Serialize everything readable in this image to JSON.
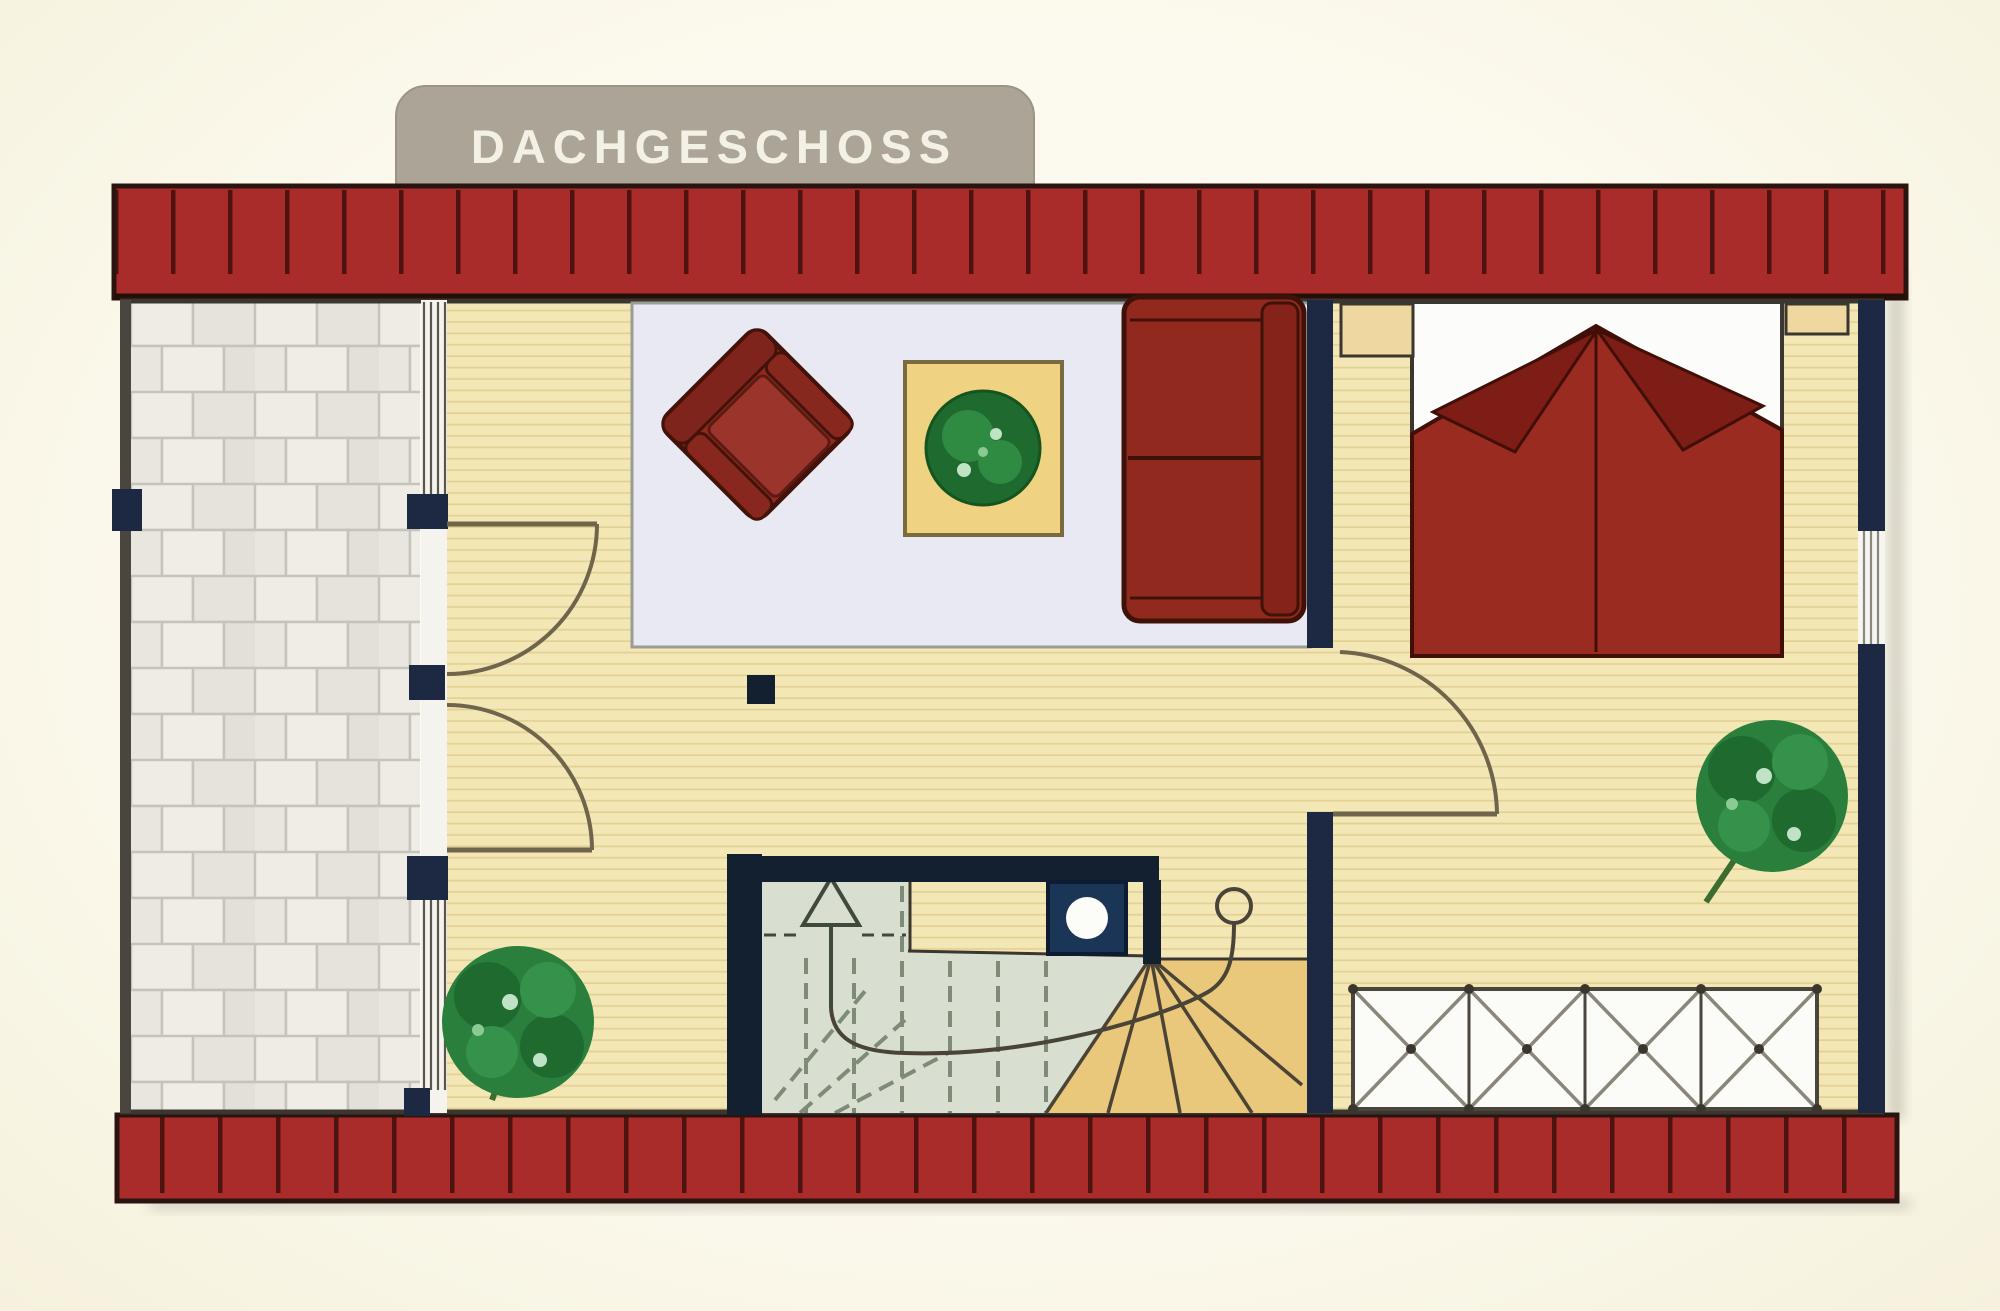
{
  "title": {
    "label": "DACHGESCHOSS"
  },
  "palette": {
    "background": "#FBF8E8",
    "banner": "#ACA496",
    "banner_text": "#F3F0E5",
    "roof_red": "#A92C2B",
    "roof_tile_line": "#4E1311",
    "wall_navy": "#1D2943",
    "wall_dark": "#13202F",
    "outline_dark": "#3B362F",
    "wood_floor": "#F4E7B6",
    "wood_stripe": "#E3D194",
    "terrace_tile_light": "#EEECE5",
    "terrace_tile_dark": "#E5E3DC",
    "terrace_grout": "#C6C3BA",
    "rug": "#E9E9F4",
    "rug_border": "#9C9C96",
    "furniture_red": "#92291E",
    "furniture_red_dark": "#7E1D16",
    "furniture_red_outline": "#401008",
    "bed_blanket_red": "#9A2B21",
    "table_wood": "#EFD383",
    "nightstand_wood": "#EED8A0",
    "plant_green": "#2A7F3C",
    "plant_green_dark": "#1F6A2F",
    "stair_sage": "#D8DFD1",
    "stair_winder_tan": "#E9C87B",
    "stair_line": "#4A4336",
    "wardrobe_white": "#FBFBF7",
    "chimney_navy": "#1B3557",
    "door_arc": "#6F644C",
    "glazing_white": "#F5F3ED"
  },
  "items": [
    "floor-title-banner",
    "roof-edge-top",
    "roof-edge-bottom",
    "terrace",
    "glazed-partition",
    "balcony-double-doors",
    "living-area",
    "area-rug",
    "armchair",
    "coffee-table",
    "potted-plant-table",
    "sofa",
    "interior-wall",
    "bedroom-door",
    "double-bed",
    "pillows",
    "nightstand-left",
    "nightstand-right",
    "potted-plant-living",
    "potted-plant-bedroom",
    "winder-staircase",
    "stair-direction-arrow",
    "stair-walkline",
    "chimney-flue",
    "structural-post",
    "wardrobe-crossed",
    "bedroom-window",
    "left-exterior-wall",
    "right-exterior-wall"
  ]
}
